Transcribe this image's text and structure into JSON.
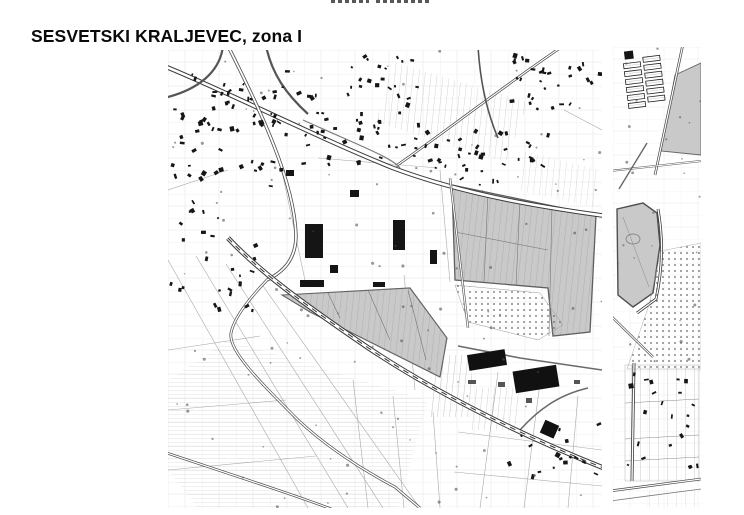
{
  "page": {
    "title": "SESVETSKI KRALJEVEC, zona I",
    "background_color": "#ffffff",
    "title_color": "#0a0a0a"
  },
  "map": {
    "kind": "black-and-white cadastral topographic scan, two panels",
    "panels": [
      {
        "name": "main-map-panel"
      },
      {
        "name": "east-map-strip-panel"
      }
    ],
    "colors": {
      "map_ink": "#1c1c1c",
      "road_casing": "#3a3a3a",
      "shaded_zone_fill": "#c9c9c9",
      "shaded_zone_outline": "#5f5f5f",
      "stipple_dot": "#666666",
      "parcel_line": "#c2c2c2",
      "paper": "#ffffff"
    }
  }
}
